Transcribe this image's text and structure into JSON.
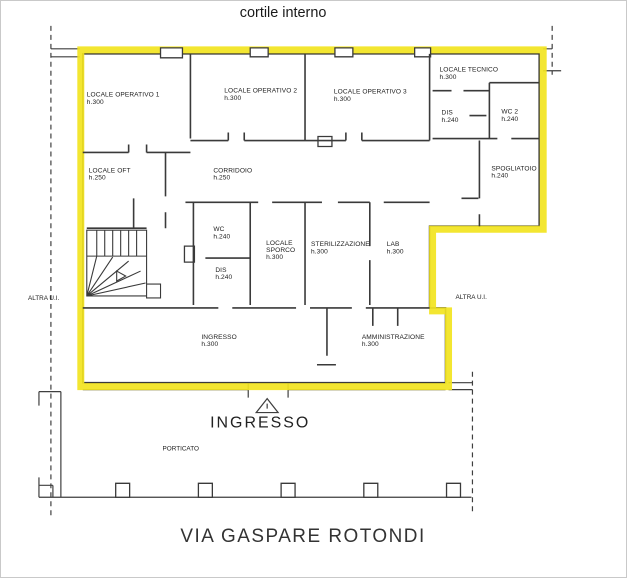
{
  "header": {
    "courtyard_label": "cortile interno"
  },
  "plan": {
    "highlight_color": "#F2E41F",
    "altra_ui_left": "ALTRA U.I.",
    "altra_ui_right": "ALTRA U.I.",
    "rooms": {
      "operativo1": {
        "name": "LOCALE OPERATIVO 1",
        "height": "h.300"
      },
      "operativo2": {
        "name": "LOCALE OPERATIVO 2",
        "height": "h.300"
      },
      "operativo3": {
        "name": "LOCALE OPERATIVO 3",
        "height": "h.300"
      },
      "tecnico": {
        "name": "LOCALE TECNICO",
        "height": "h.300"
      },
      "dis_top": {
        "name": "DIS",
        "height": "h.240"
      },
      "wc2": {
        "name": "WC 2",
        "height": "h.240"
      },
      "oft": {
        "name": "LOCALE OFT",
        "height": "h.250"
      },
      "corridoio": {
        "name": "CORRIDOIO",
        "height": "h.250"
      },
      "spogliatoio": {
        "name": "SPOGLIATOIO",
        "height": "h.240"
      },
      "wc": {
        "name": "WC",
        "height": "h.240"
      },
      "dis_mid": {
        "name": "DIS",
        "height": "h.240"
      },
      "sporco": {
        "lines": [
          "LOCALE",
          "SPORCO",
          "h.300"
        ]
      },
      "sterilizzazione": {
        "name": "STERILIZZAZIONE",
        "height": "h.300"
      },
      "lab": {
        "name": "LAB",
        "height": "h.300"
      },
      "ingresso": {
        "name": "INGRESSO",
        "height": "h.300"
      },
      "amministrazione": {
        "name": "AMMINISTRAZIONE",
        "height": "h.300"
      }
    }
  },
  "footer": {
    "entrance_label": "INGRESSO",
    "porticato_label": "PORTICATO",
    "street_label": "VIA GASPARE ROTONDI"
  }
}
